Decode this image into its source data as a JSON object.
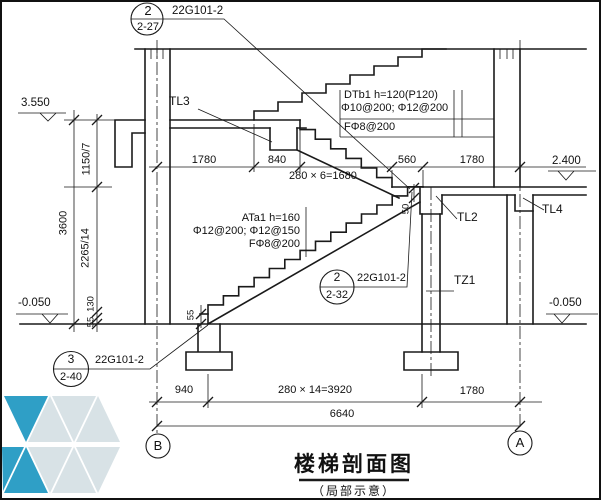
{
  "drawing": {
    "title": "楼梯剖面图",
    "subtitle": "（局部示意）",
    "detail_refs": {
      "top": {
        "num": "2",
        "sheet": "2-27",
        "std": "22G101-2"
      },
      "mid": {
        "num": "2",
        "sheet": "2-32",
        "std": "22G101-2"
      },
      "bottom": {
        "num": "3",
        "sheet": "2-40",
        "std": "22G101-2"
      }
    },
    "levels": {
      "floor_upper": "3.550",
      "landing": "2.400",
      "ground_left": "-0.050",
      "ground_right": "-0.050"
    },
    "dims": {
      "vertical": {
        "upper_flight": "1150/7",
        "storey": "3600",
        "lower_flight": "2265/14",
        "d130": "130",
        "d55": "55",
        "d55_base": "55",
        "d50": "50"
      },
      "mid_chain": [
        "1780",
        "840",
        "280 × 6=1680",
        "560",
        "1780"
      ],
      "bottom_chain": [
        "940",
        "280 × 14=3920",
        "1780"
      ],
      "total": "6640"
    },
    "members": {
      "tl3": "TL3",
      "tl2": "TL2",
      "tl4": "TL4",
      "tz1": "TZ1"
    },
    "notes": {
      "dtb1": {
        "l1": "DTb1  h=120(P120)",
        "l2": "Φ10@200; Φ12@200",
        "l3": "FΦ8@200"
      },
      "ata1": {
        "l1": "ATa1  h=160",
        "l2": "Φ12@200; Φ12@150",
        "l3": "FΦ8@200"
      }
    },
    "grids": {
      "left": "B",
      "right": "A"
    },
    "colors": {
      "line": "#1a1a1a",
      "logo_blue": "#2f9fc6",
      "logo_light": "#d8e2e6"
    }
  }
}
